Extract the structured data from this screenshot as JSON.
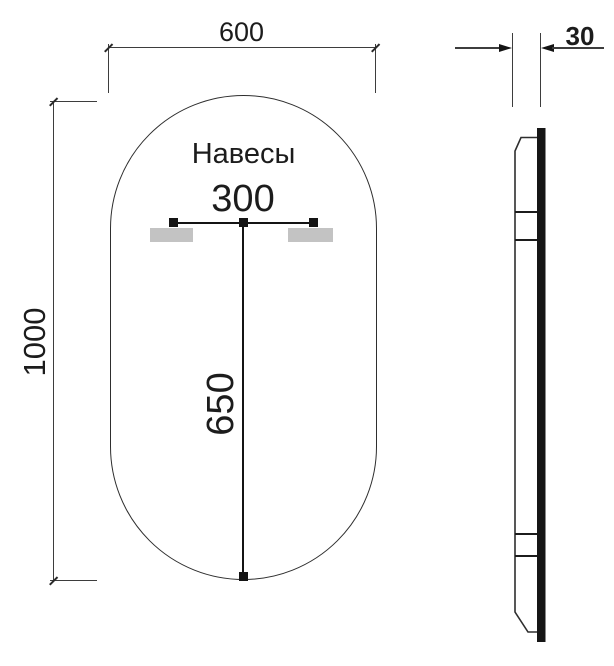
{
  "front_view": {
    "hangers_label": "Навесы",
    "width_dim": "600",
    "height_dim": "1000",
    "hanger_spacing_dim": "300",
    "hanger_drop_dim": "650"
  },
  "side_view": {
    "thickness_dim": "30"
  },
  "colors": {
    "line": "#3d3d3d",
    "bold_line": "#141414",
    "hanger_fill": "#c3c3c3",
    "background": "#ffffff"
  }
}
